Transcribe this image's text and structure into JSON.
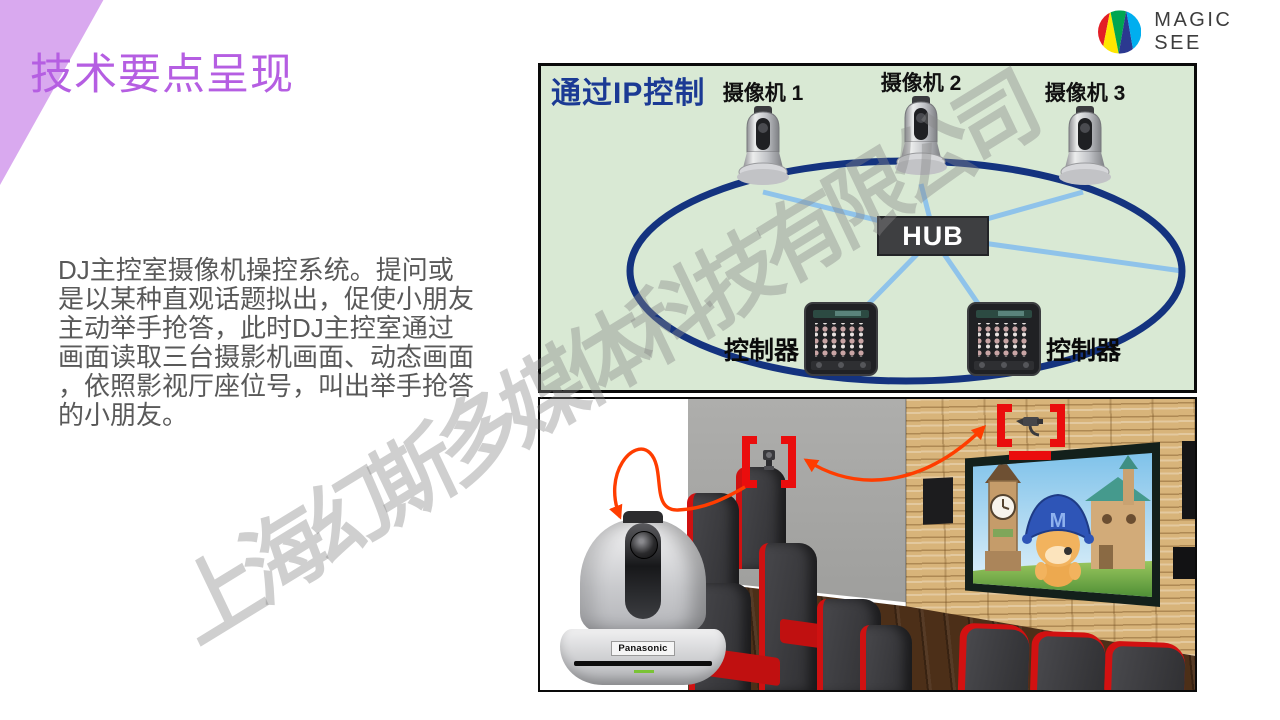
{
  "slide": {
    "title": "技术要点呈现"
  },
  "logo": {
    "text": "MAGIC SEE",
    "wedge_colors": [
      "#e31e26",
      "#ffe600",
      "#00a651",
      "#2b3990",
      "#00aeef"
    ]
  },
  "body": {
    "text_color": "#595959",
    "lines": [
      "DJ主控室摄像机操控系统。提问或",
      "是以某种直观话题拟出，促使小朋友",
      "主动举手抢答，此时DJ主控室通过",
      "画面读取三台摄影机画面、动态画面",
      "，依照影视厅座位号，叫出举手抢答",
      "的小朋友。"
    ]
  },
  "diagram": {
    "title": "通过IP控制",
    "title_color": "#1b3a94",
    "background": "#d9e9d4",
    "ring_color": "#14337f",
    "link_color": "#8fc3ea",
    "hub_label": "HUB",
    "camera_labels": [
      "摄像机 1",
      "摄像机 2",
      "摄像机 3"
    ],
    "controller_labels": [
      "控制器",
      "控制器"
    ]
  },
  "photo": {
    "camera_brand": "Panasonic",
    "marker_color": "#ea0d0d",
    "arrow_color": "#ff3d00",
    "hat_letter": "M"
  },
  "watermark": {
    "text": "上海幻斯多媒体科技有限公司"
  }
}
